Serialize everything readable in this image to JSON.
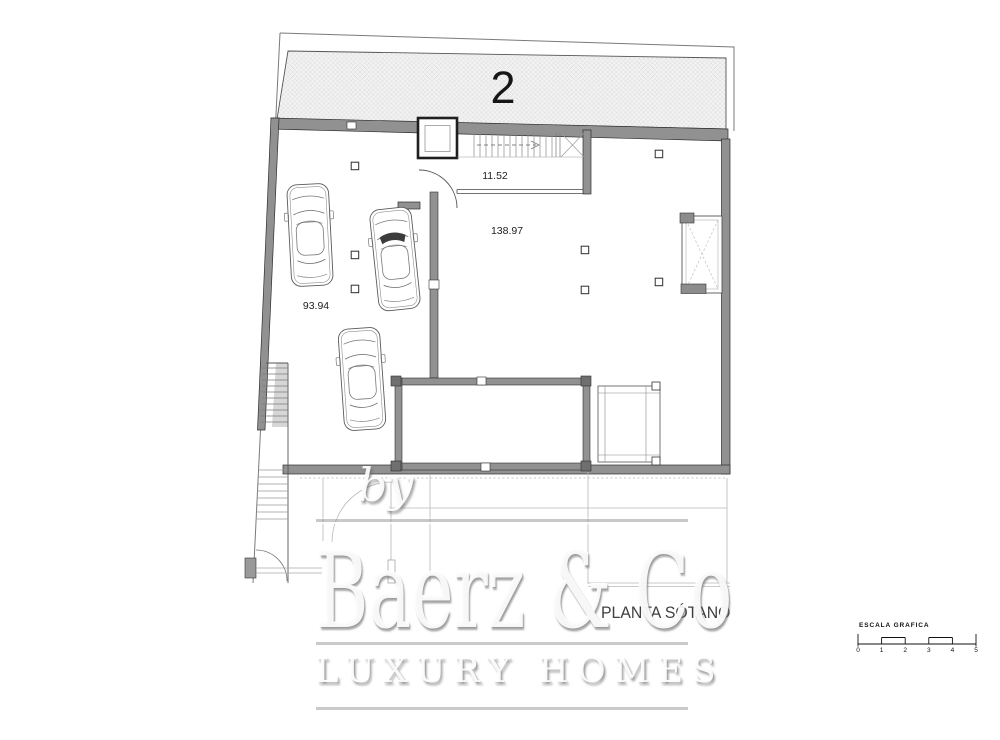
{
  "plan": {
    "unit_number": "2",
    "title": "PLANTA SÓTANO",
    "areas": {
      "staircase": "11.52",
      "main_room": "138.97",
      "garage": "93.94"
    }
  },
  "scalebar": {
    "label": "ESCALA GRAFICA",
    "ticks": [
      "0",
      "1",
      "2",
      "3",
      "4",
      "5"
    ]
  },
  "watermark": {
    "prefix": "by",
    "brand": "Baerz & Co",
    "tagline": "LUXURY HOMES"
  },
  "colors": {
    "wall_fill": "#919191",
    "hatch_fill": "#f2f2f2",
    "line_dark": "#2e2e2e",
    "faint_line": "#b8b8b8"
  }
}
